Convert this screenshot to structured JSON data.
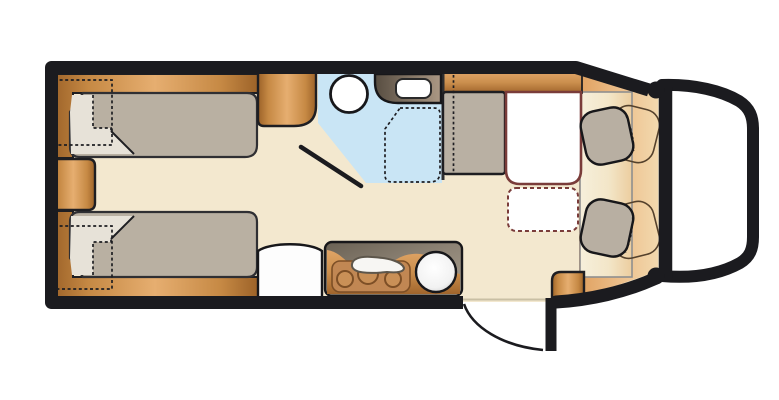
{
  "vehicle": {
    "kind": "motorhome-floor-plan",
    "orientation": "rear-left-front-right",
    "rooms": [
      {
        "name": "rear-bedroom",
        "fixtures": [
          "single-bed-top",
          "single-bed-bottom",
          "folded-blanket-top",
          "folded-blanket-bottom",
          "overhead-locker-dashed-top",
          "overhead-locker-dashed-bottom",
          "rear-center-cabinet",
          "wardrobe"
        ]
      },
      {
        "name": "bathroom",
        "fixtures": [
          "toilet",
          "washbasin",
          "shower-tray-dashed",
          "bathroom-door"
        ]
      },
      {
        "name": "kitchen",
        "fixtures": [
          "three-burner-hob",
          "round-sink",
          "worktop",
          "fridge-or-cabinet"
        ]
      },
      {
        "name": "lounge",
        "fixtures": [
          "side-bench",
          "table",
          "table-extension-dashed",
          "sideboard-wood-strip"
        ]
      },
      {
        "name": "cab",
        "fixtures": [
          "driver-swivel-seat",
          "passenger-swivel-seat",
          "seat-turned-position-outline-top",
          "seat-turned-position-outline-bottom",
          "cab-floor"
        ]
      },
      {
        "name": "entrance",
        "fixtures": [
          "entry-door-leaf",
          "entry-door-swing-arc",
          "entry-step-cabinet"
        ]
      }
    ]
  },
  "colors": {
    "page_bg": "#ffffff",
    "body_outline": "#1b1b1f",
    "floor": "#f3e8cf",
    "bathroom": "#c9e5f5",
    "wood_dark": "#9c6228",
    "wood_mid": "#c68944",
    "wood_light": "#e6ae70",
    "mattress": "#b9b0a2",
    "blanket": "#e7e2d8",
    "bench": "#b9b0a3",
    "seat": "#b8afa2",
    "counter_dark": "#6a6154",
    "counter_light": "#a89e8e",
    "basin_counter_dark": "#564c40",
    "basin_counter_light": "#ab9884",
    "table_border": "#7a3c3a",
    "cab_floor_tan": "#eebb7e",
    "cab_rect_line": "#8f8f8f",
    "sink_white": "#ffffff",
    "ghost_outline": "#54412c"
  }
}
